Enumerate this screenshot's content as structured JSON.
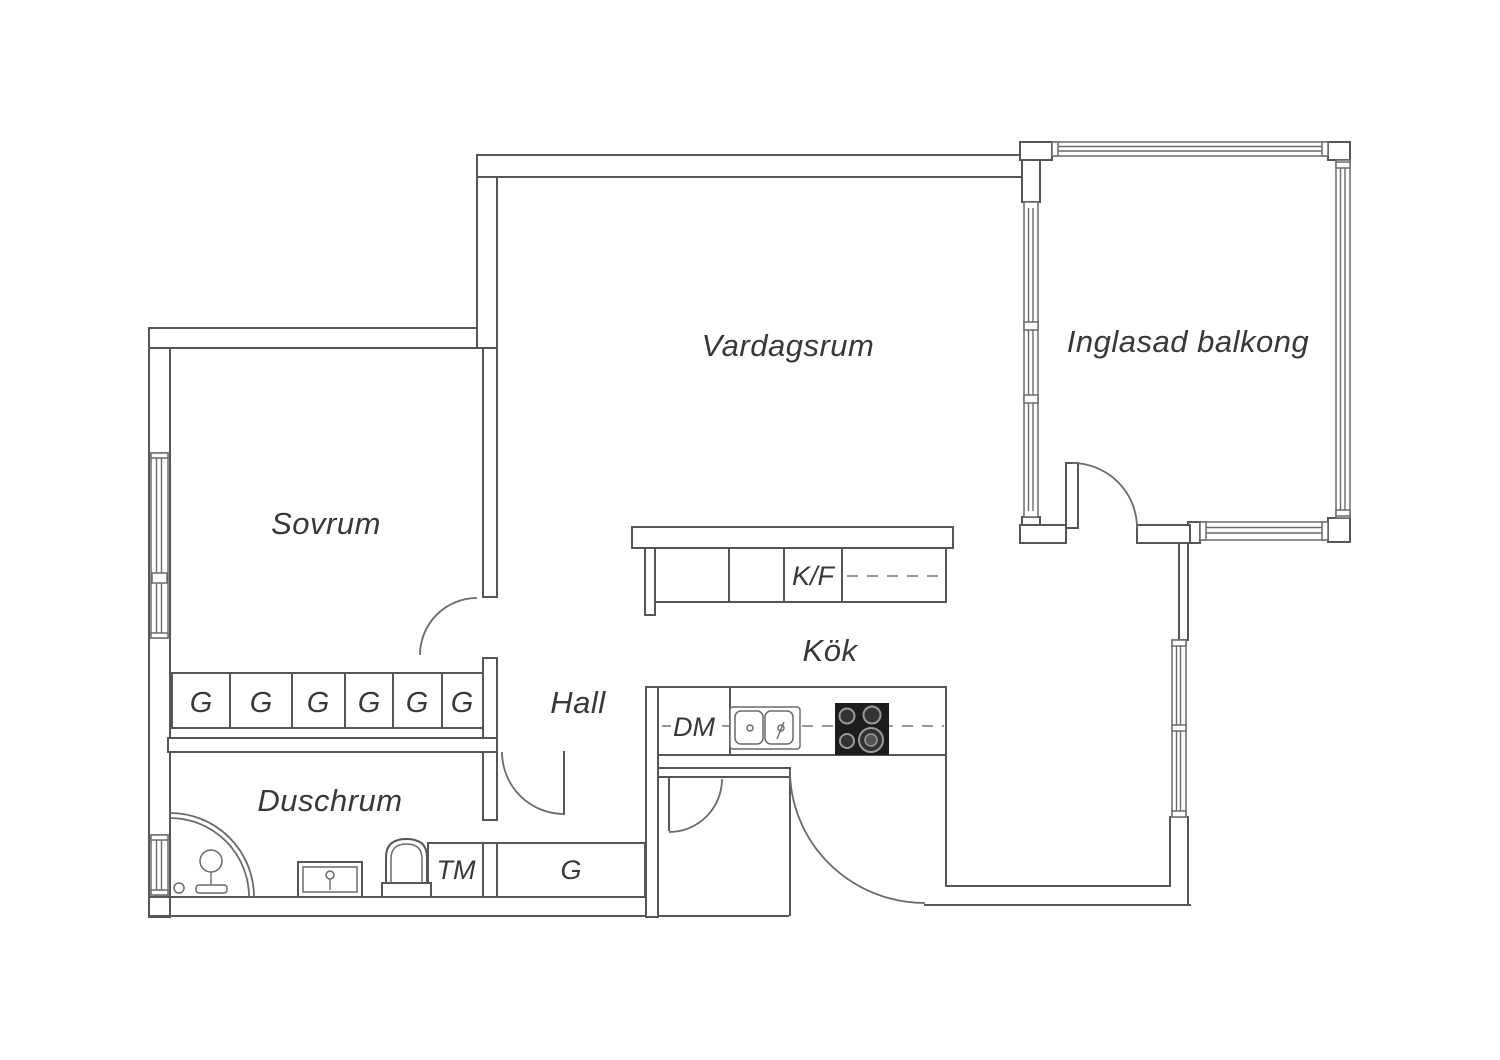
{
  "canvas": {
    "width": 1500,
    "height": 1060,
    "background": "#ffffff"
  },
  "colors": {
    "wall_line": "#565656",
    "text": "#383838",
    "stove": "#1c1c1c",
    "dashed_line": "#777777"
  },
  "rooms": {
    "bedroom": "Sovrum",
    "living_room": "Vardagsrum",
    "balcony": "Inglasad balkong",
    "kitchen": "Kök",
    "hall": "Hall",
    "shower_room": "Duschrum"
  },
  "appliances": {
    "fridge_freezer": "K/F",
    "dishwasher": "DM",
    "washing_machine": "TM",
    "closet": "G"
  },
  "wardrobe_row": {
    "cells": [
      "G",
      "G",
      "G",
      "G",
      "G",
      "G"
    ]
  }
}
